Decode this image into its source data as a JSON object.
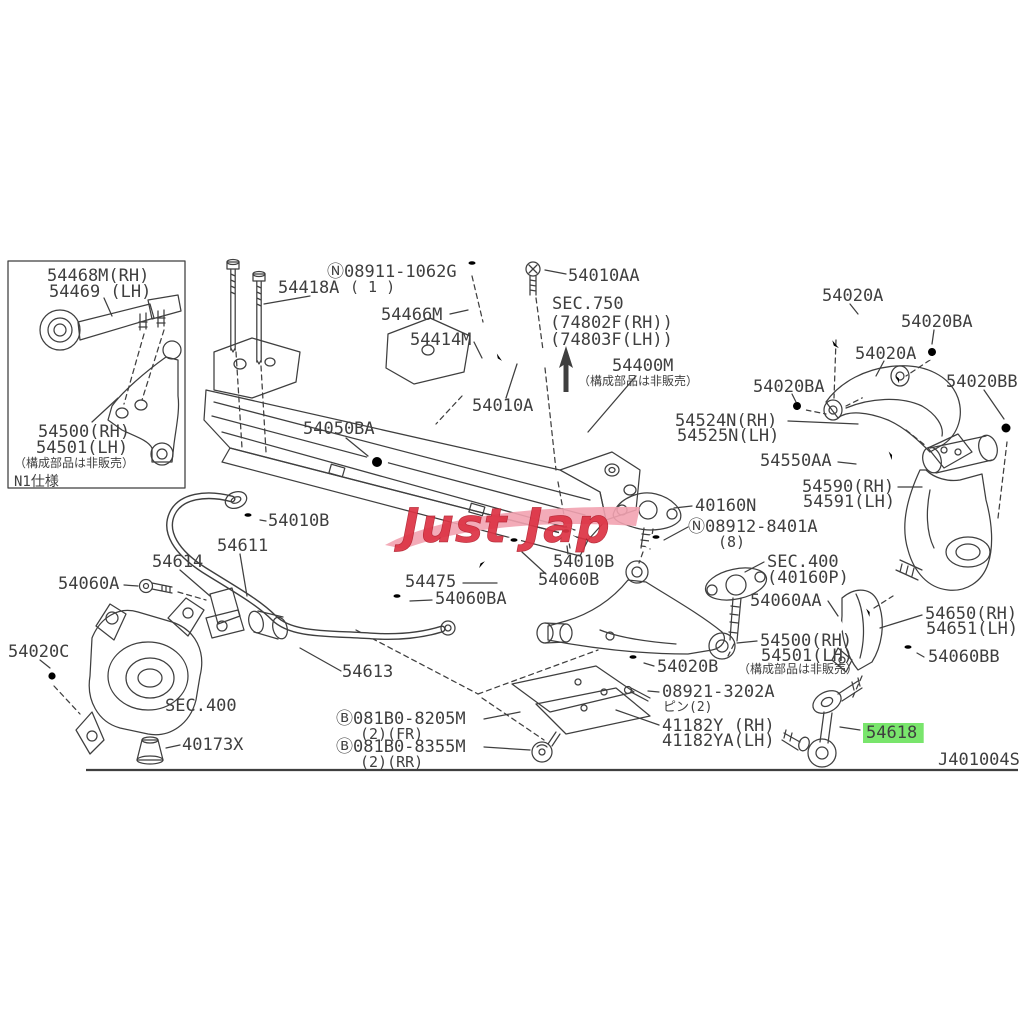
{
  "diagram": {
    "watermark": "Just Jap",
    "highlight_color": "#79e56c",
    "line_color": "#3f3f3f",
    "background": "#ffffff"
  },
  "labels": [
    {
      "text": "54468M(RH)",
      "x": 47,
      "y": 281
    },
    {
      "text": "54469 (LH)",
      "x": 49,
      "y": 297
    },
    {
      "text": "54500(RH)",
      "x": 38,
      "y": 437
    },
    {
      "text": "54501(LH)",
      "x": 36,
      "y": 453
    },
    {
      "text": "（構成部品は非販売）",
      "x": 14,
      "y": 467,
      "fs": 12
    },
    {
      "text": "N1仕様",
      "x": 14,
      "y": 486,
      "fs": 14
    },
    {
      "text": "Ⓝ08911-1062G",
      "x": 327,
      "y": 277
    },
    {
      "text": "( 1 )",
      "x": 350,
      "y": 292,
      "fs": 15
    },
    {
      "text": "54418A",
      "x": 278,
      "y": 293
    },
    {
      "text": "54466M",
      "x": 381,
      "y": 320
    },
    {
      "text": "54414M",
      "x": 410,
      "y": 345
    },
    {
      "text": "54010A",
      "x": 472,
      "y": 411
    },
    {
      "text": "54010AA",
      "x": 568,
      "y": 281
    },
    {
      "text": "SEC.750",
      "x": 552,
      "y": 309
    },
    {
      "text": "(74802F(RH))",
      "x": 550,
      "y": 328
    },
    {
      "text": "(74803F(LH))",
      "x": 550,
      "y": 345
    },
    {
      "text": "54400M",
      "x": 612,
      "y": 371
    },
    {
      "text": "（構成部品は非販売）",
      "x": 578,
      "y": 385,
      "fs": 12
    },
    {
      "text": "54050BA",
      "x": 303,
      "y": 434
    },
    {
      "text": "54020A",
      "x": 822,
      "y": 301
    },
    {
      "text": "54020BA",
      "x": 901,
      "y": 327
    },
    {
      "text": "54020A",
      "x": 855,
      "y": 359
    },
    {
      "text": "54020BA",
      "x": 753,
      "y": 392
    },
    {
      "text": "54020BB",
      "x": 946,
      "y": 387
    },
    {
      "text": "54524N(RH)",
      "x": 675,
      "y": 426
    },
    {
      "text": "54525N(LH)",
      "x": 677,
      "y": 441
    },
    {
      "text": "54550AA",
      "x": 760,
      "y": 466
    },
    {
      "text": "54590(RH)",
      "x": 802,
      "y": 492
    },
    {
      "text": "54591(LH)",
      "x": 803,
      "y": 507
    },
    {
      "text": "40160N",
      "x": 695,
      "y": 511
    },
    {
      "text": "Ⓝ08912-8401A",
      "x": 688,
      "y": 532
    },
    {
      "text": "(8)",
      "x": 718,
      "y": 547,
      "fs": 15
    },
    {
      "text": "SEC.400",
      "x": 767,
      "y": 567
    },
    {
      "text": "(40160P)",
      "x": 767,
      "y": 583
    },
    {
      "text": "54060AA",
      "x": 750,
      "y": 606
    },
    {
      "text": "54650(RH)",
      "x": 925,
      "y": 619
    },
    {
      "text": "54651(LH)",
      "x": 926,
      "y": 634
    },
    {
      "text": "54500(RH)",
      "x": 760,
      "y": 646
    },
    {
      "text": "54501(LH)",
      "x": 761,
      "y": 661
    },
    {
      "text": "（構成部品は非販売）",
      "x": 738,
      "y": 673,
      "fs": 12
    },
    {
      "text": "54060BB",
      "x": 928,
      "y": 662
    },
    {
      "text": "54020B",
      "x": 657,
      "y": 672
    },
    {
      "text": "08921-3202A",
      "x": 662,
      "y": 697
    },
    {
      "text": "ピン(2)",
      "x": 663,
      "y": 711,
      "fs": 13
    },
    {
      "text": "41182Y (RH)",
      "x": 662,
      "y": 731
    },
    {
      "text": "41182YA(LH)",
      "x": 662,
      "y": 746
    },
    {
      "text": "54618",
      "x": 866,
      "y": 738,
      "highlight": true,
      "name": "highlighted-part-number"
    },
    {
      "text": "54613",
      "x": 342,
      "y": 677
    },
    {
      "text": "Ⓑ081B0-8205M",
      "x": 336,
      "y": 724
    },
    {
      "text": "(2)(FR)",
      "x": 360,
      "y": 739,
      "fs": 15
    },
    {
      "text": "Ⓑ081B0-8355M",
      "x": 336,
      "y": 752
    },
    {
      "text": "(2)(RR)",
      "x": 360,
      "y": 767,
      "fs": 15
    },
    {
      "text": "54611",
      "x": 217,
      "y": 551
    },
    {
      "text": "54614",
      "x": 152,
      "y": 567
    },
    {
      "text": "54060A",
      "x": 58,
      "y": 589
    },
    {
      "text": "54020C",
      "x": 8,
      "y": 657
    },
    {
      "text": "SEC.400",
      "x": 165,
      "y": 711
    },
    {
      "text": "40173X",
      "x": 182,
      "y": 750
    },
    {
      "text": "54475",
      "x": 405,
      "y": 587
    },
    {
      "text": "54060BA",
      "x": 435,
      "y": 604
    },
    {
      "text": "54010B",
      "x": 553,
      "y": 567
    },
    {
      "text": "54060B",
      "x": 538,
      "y": 585
    },
    {
      "text": "54010B",
      "x": 268,
      "y": 526
    },
    {
      "text": "J401004S",
      "x": 938,
      "y": 765,
      "name": "diagram-code"
    }
  ]
}
